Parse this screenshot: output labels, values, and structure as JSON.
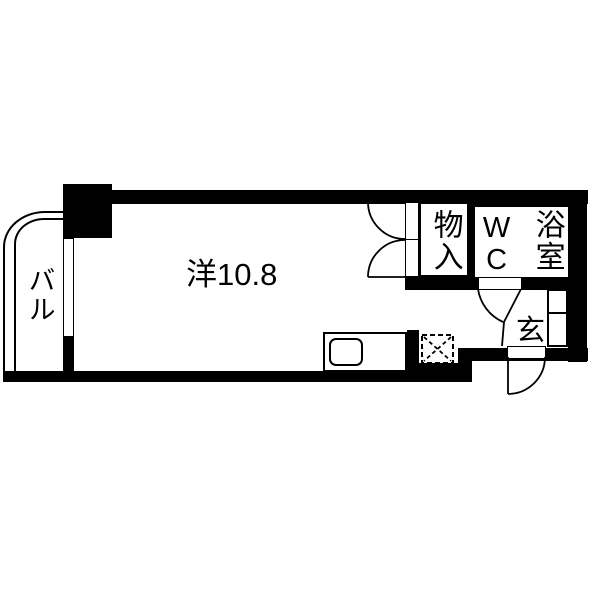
{
  "floorplan": {
    "title": "apartment-floor-plan",
    "colors": {
      "wall": "#000000",
      "floor": "#ffffff",
      "line": "#000000"
    },
    "rooms": {
      "main_room": {
        "label": "洋10.8",
        "type": "western-room",
        "size_tatami": "10.8"
      },
      "balcony": {
        "label": "バル"
      },
      "closet": {
        "label": "物入"
      },
      "toilet": {
        "label": "WC"
      },
      "bath": {
        "label": "浴室"
      },
      "entrance": {
        "label": "玄"
      }
    },
    "fixtures": {
      "kitchen_sink": "sink-counter",
      "washer_space": "dashed-square-with-x",
      "shoe_cabinet": "two-stacked-boxes",
      "doors": [
        "closet-double-doors",
        "wc-door",
        "entry-door"
      ],
      "window": "left-wall-window"
    }
  }
}
